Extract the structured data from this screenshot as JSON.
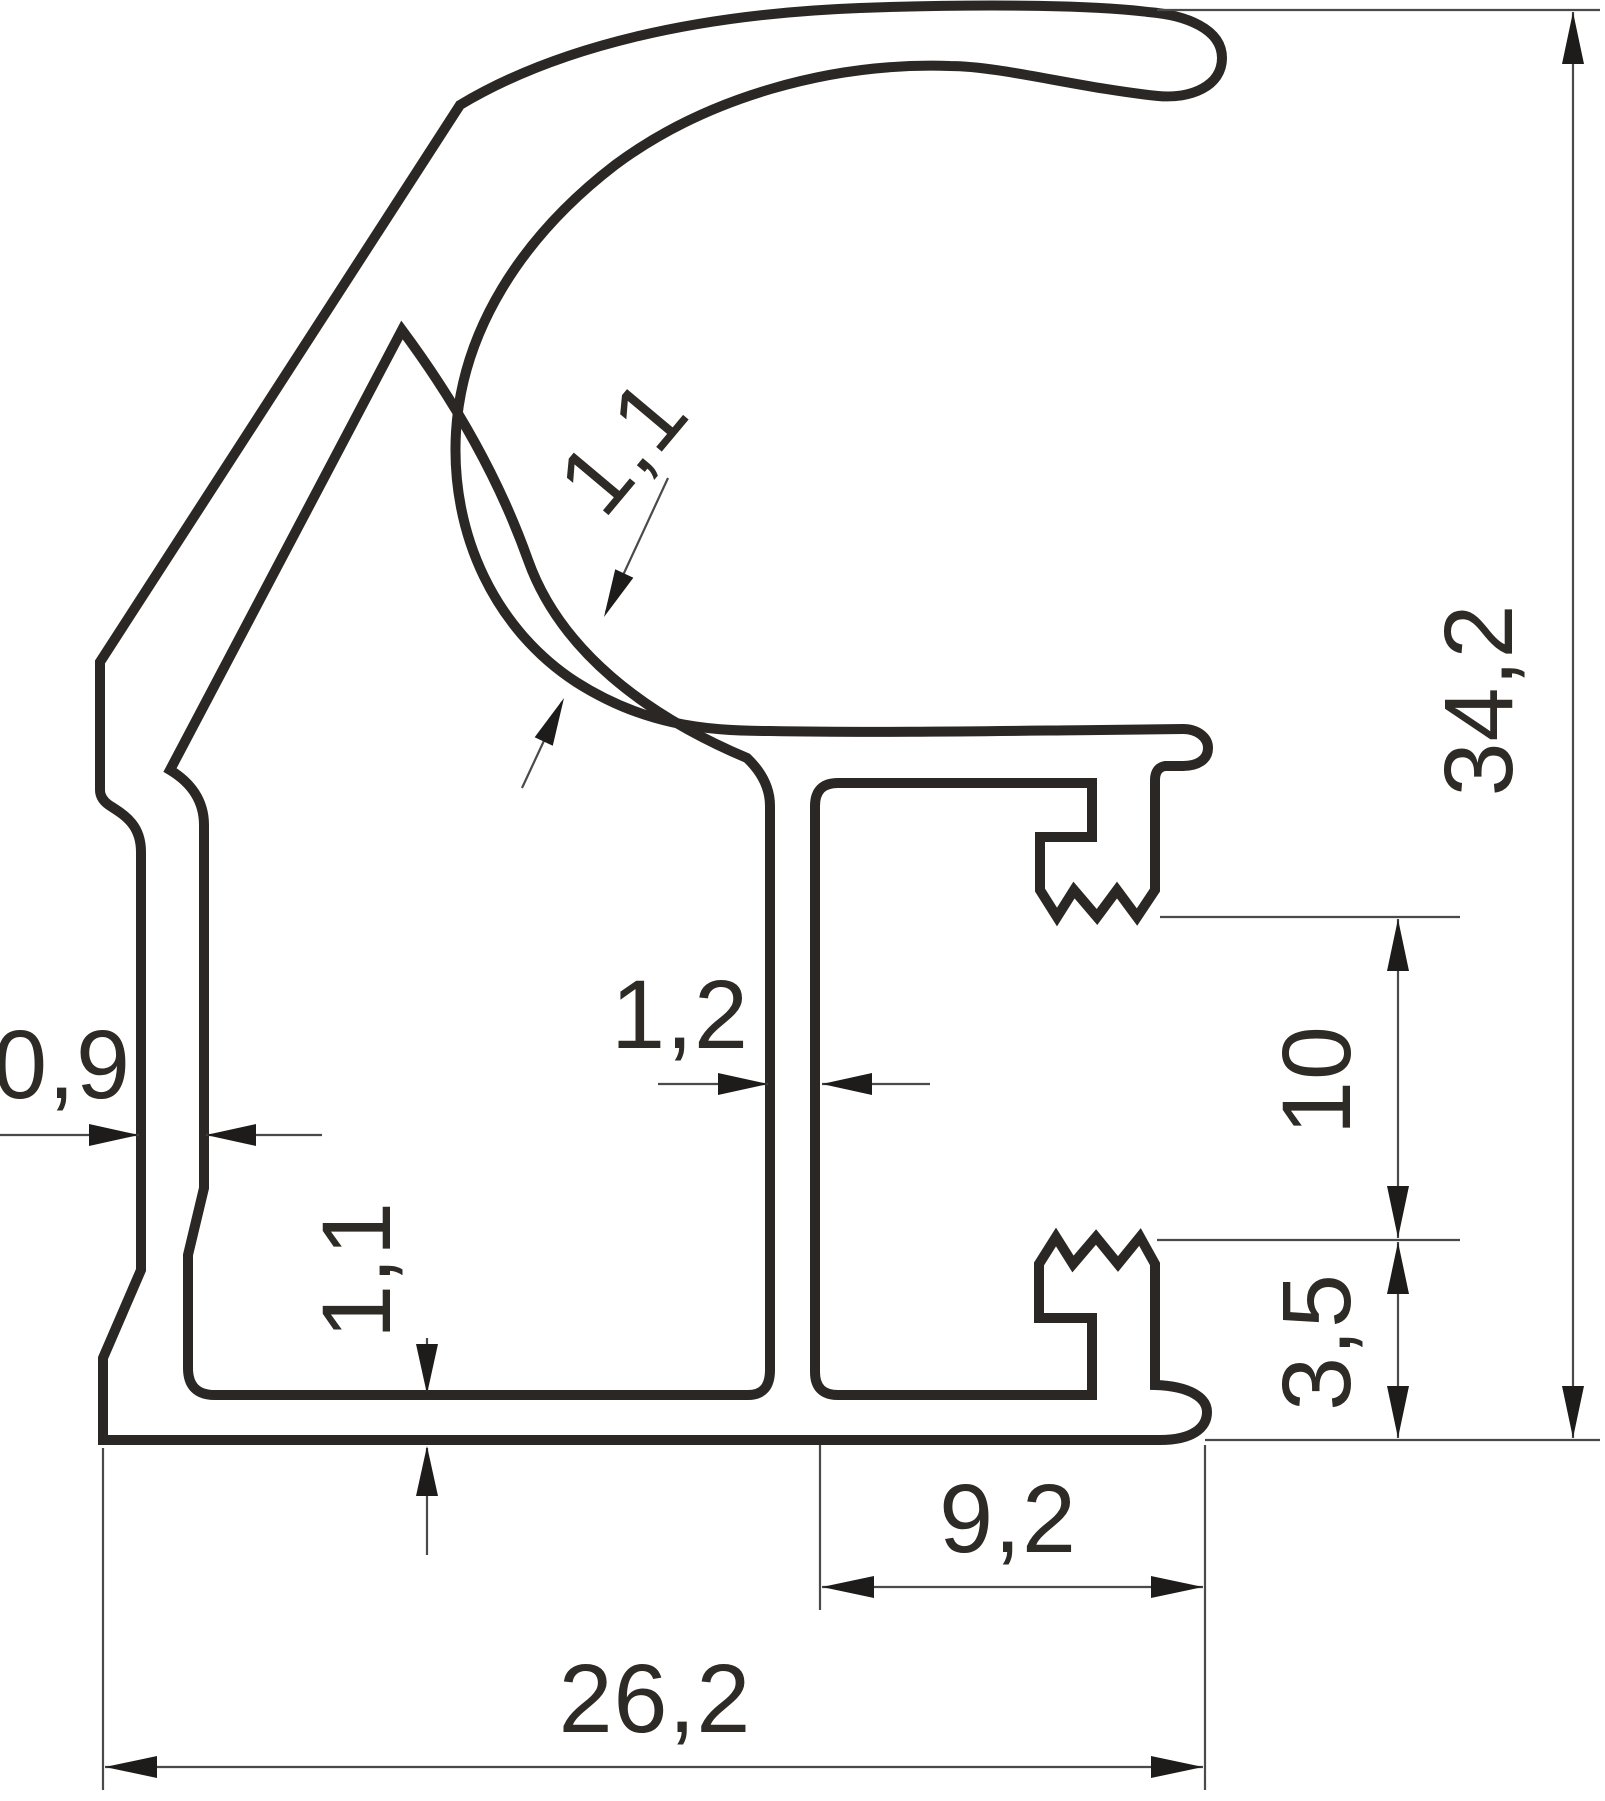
{
  "drawing": {
    "type": "profile-cross-section-technical-drawing",
    "colors": {
      "outline": "#2b2724",
      "dimension_lines": "#4a4a4a",
      "arrows": "#1e1c1a",
      "text": "#2e2a26",
      "background": "#ffffff"
    },
    "dimensions": {
      "overall_height": "34,2",
      "overall_width": "26,2",
      "hook_gap": "10",
      "hook_to_bottom": "3,5",
      "channel_width": "9,2",
      "left_wall_thickness": "0,9",
      "center_wall_thickness": "1,2",
      "ring_wall_thickness": "1,1",
      "bottom_wall_thickness": "1,1"
    }
  }
}
